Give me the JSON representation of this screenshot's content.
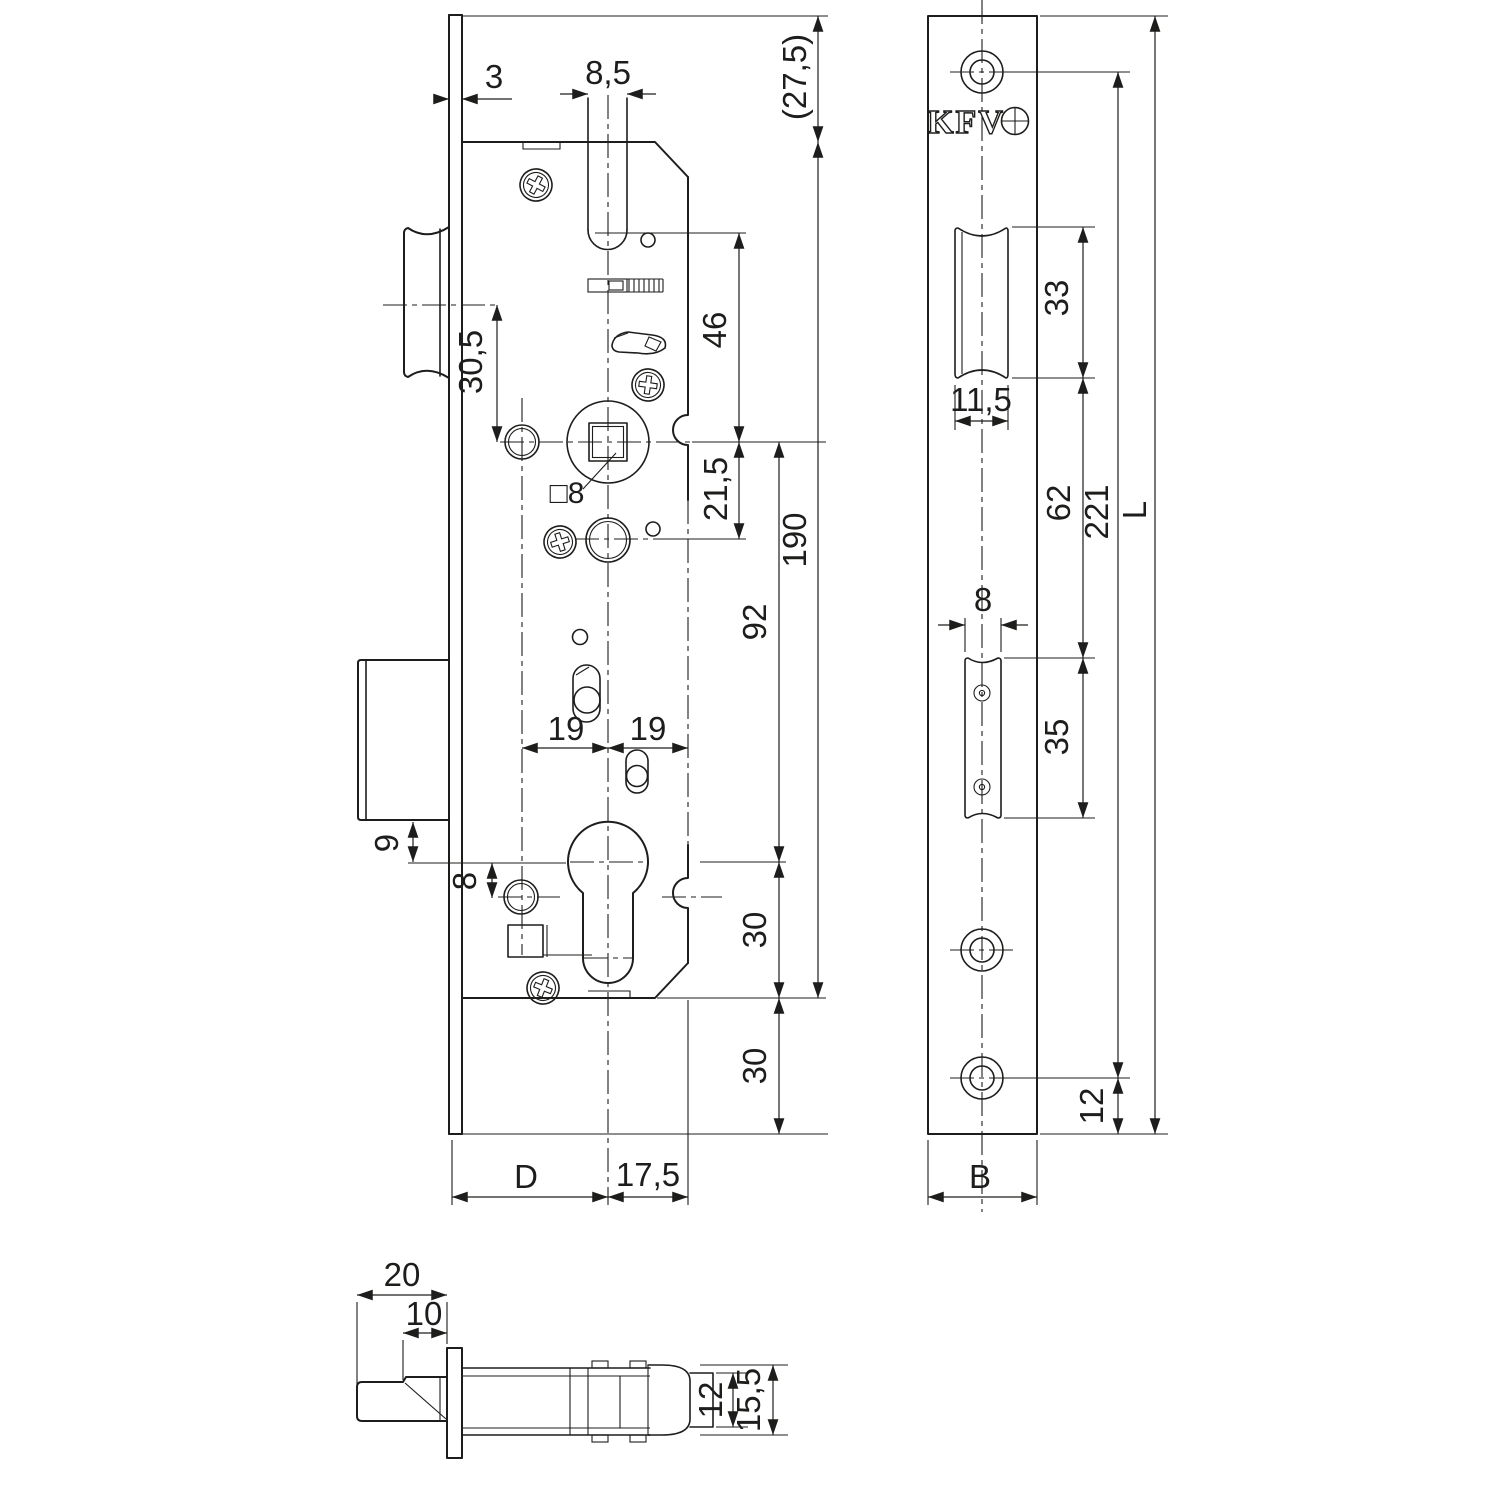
{
  "drawing": {
    "kind": "mortise-lock technical drawing",
    "brand": "KFV",
    "line_color": "#1d1d1b",
    "background": "#ffffff"
  },
  "side_view": {
    "d3": "3",
    "d85": "8,5",
    "d275": "(27,5)",
    "d305": "30,5",
    "d46": "46",
    "d215": "21,5",
    "d190": "190",
    "d92": "92",
    "d19a": "19",
    "d19b": "19",
    "d9": "9",
    "d8": "8",
    "dsq8": "□8",
    "d30a": "30",
    "d30b": "30",
    "dD": "D",
    "d175": "17,5"
  },
  "faceplate_view": {
    "brand": "KFV",
    "d33": "33",
    "d115": "11,5",
    "d62": "62",
    "d221": "221",
    "dL": "L",
    "d8": "8",
    "d35": "35",
    "d12": "12",
    "dB": "B"
  },
  "latch_view": {
    "d20": "20",
    "d10": "10",
    "d12": "12",
    "d155": "15,5"
  }
}
